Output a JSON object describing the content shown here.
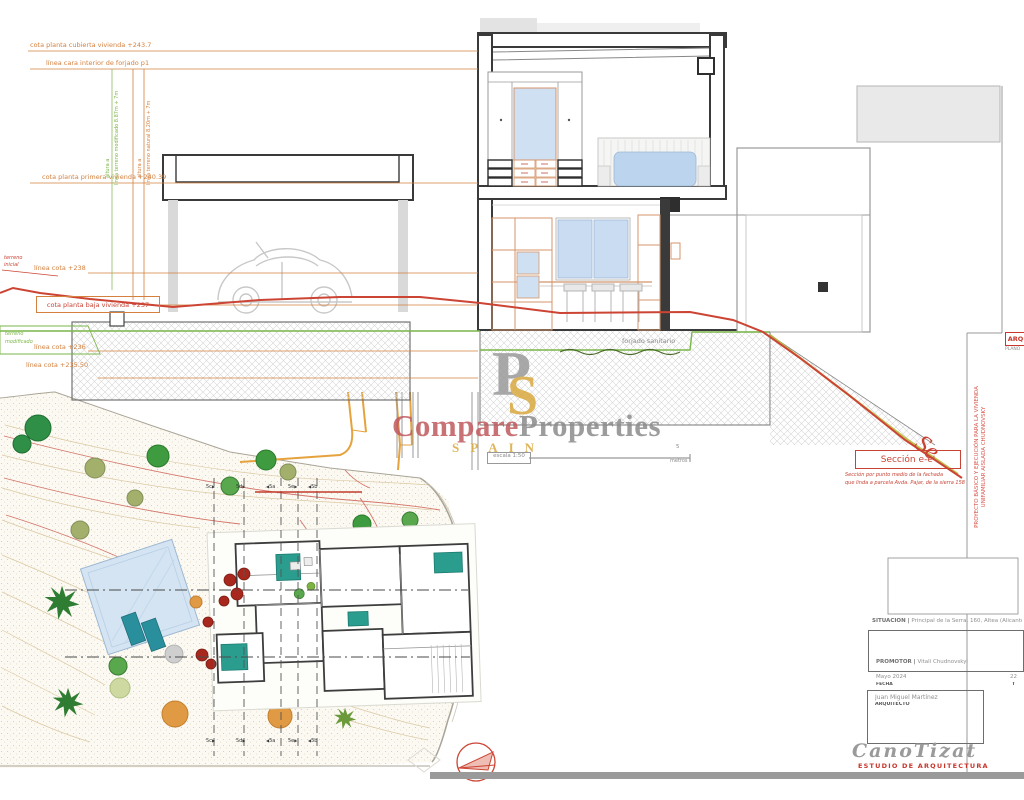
{
  "annotations": {
    "cota_cubierta": "cota planta cubierta vivienda +243.7",
    "linea_forjado": "línea cara interior de forjado p1",
    "cota_primera": "cota planta primera vivienda +240.39",
    "linea_238": "línea cota +238",
    "cota_baja": "cota planta baja vivienda +237",
    "linea_236": "línea cota +236",
    "linea_23550": "línea cota +235.50",
    "terreno_inicial_1": "terreno",
    "terreno_inicial_2": "inicial",
    "terreno_modificado_1": "terreno",
    "terreno_modificado_2": "modificado",
    "altura_verde": "línea terreno modificado 8.87m + 7m",
    "altura_verde_pre": "altura a",
    "altura_naranja": "línea terreno natural 8.20m + 7m",
    "altura_naranja_pre": "altura a",
    "forjado_sanitario": "forjado sanitario"
  },
  "watermark": {
    "monogram_p": "P",
    "monogram_s": "S",
    "compare": "Compare",
    "properties": "Properties",
    "spain": "SPAIN"
  },
  "scalebar": {
    "label": "escala 1:50",
    "value": "5",
    "unit": "metros"
  },
  "seccion": {
    "title": "Sección e-e'",
    "caption_1": "Sección por punto medio de la fachada",
    "caption_2": "que linda a parcela Avda. Pajar, de la sierra 158",
    "se": "Se"
  },
  "titleblock": {
    "proyecto_1": "PROYECTO BÁSICO Y EJECUCIÓN PARA LA VIVIENDA",
    "proyecto_2": "UNIFAMILIAR AISLADA CHUDNOVSKY",
    "arq": "ARQ",
    "plano": "PLANO",
    "situacion_label": "SITUACIÓN |",
    "situacion_value": "Principal de la Serra, 160, Altea (Alicante",
    "promotor_label": "PROMOTOR |",
    "promotor_value": "Vitali Chudnovskyi",
    "fecha_value": "Mayo 2024",
    "fecha_label": "FECHA",
    "num_right": "22",
    "t_right": "T",
    "arquitecto_nombre": "Juan Miguel Martínez",
    "arquitecto_titulo": "ARQUITECTO",
    "estudio_nombre": "CanoTizat",
    "estudio_sub": "ESTUDIO DE ARQUITECTURA"
  },
  "siteplan": {
    "markers_top": [
      "5c",
      "5d",
      "5a",
      "5e",
      "5b"
    ],
    "markers_bottom": [
      "5c",
      "5d",
      "5a",
      "5e",
      "5b"
    ]
  },
  "colors": {
    "annotation_orange": "#d4813f",
    "annotation_green": "#7ab648",
    "terrain_red": "#cc4433",
    "watermark_rose": "#c05a5e",
    "watermark_gold": "#d9a93e",
    "furniture_teal": "#2a9d8f",
    "glass_blue": "#c9dcf2"
  }
}
